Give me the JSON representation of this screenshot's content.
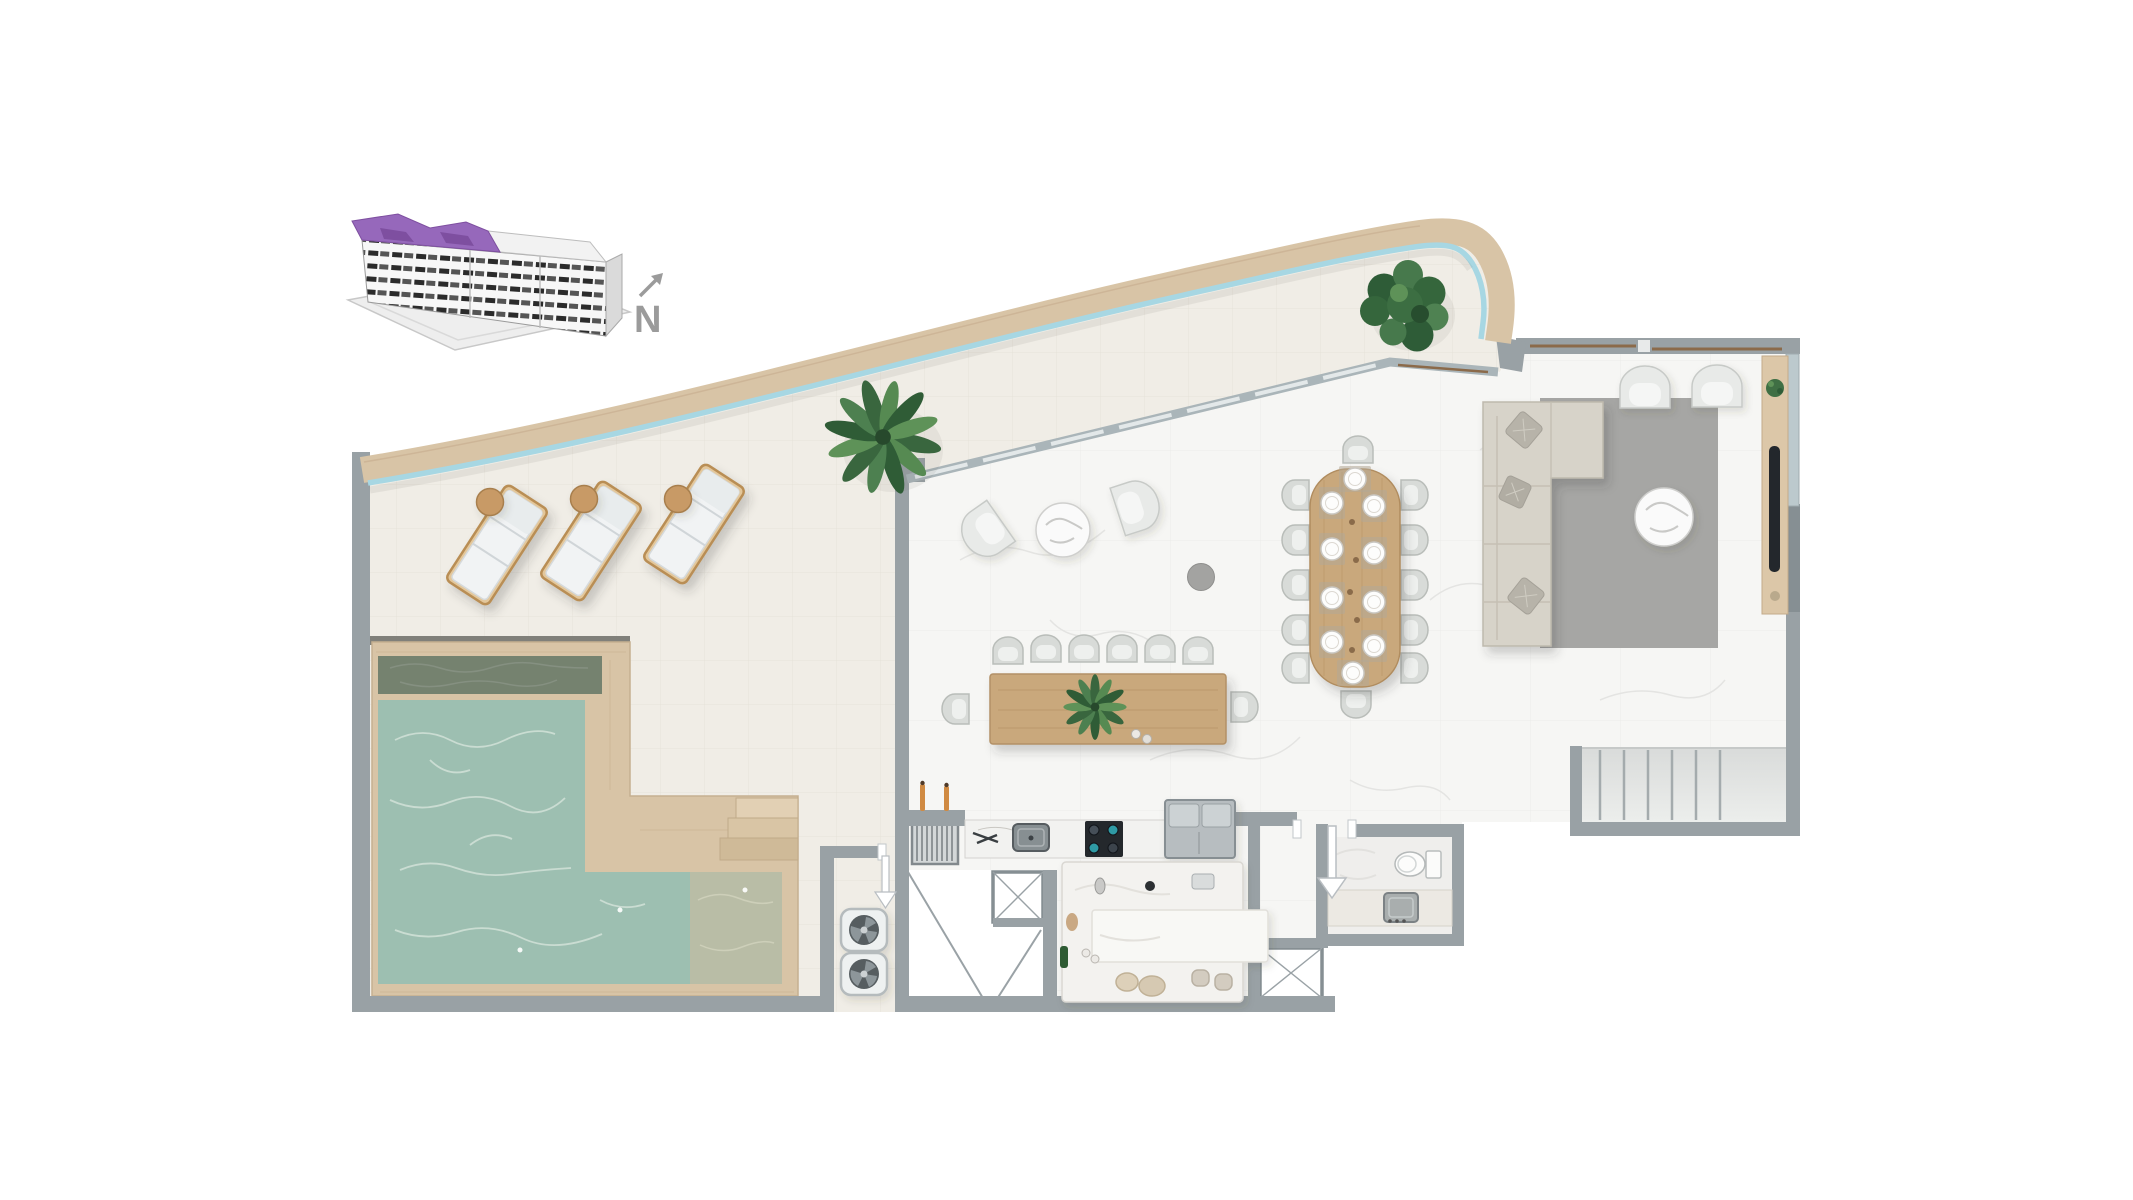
{
  "compass": {
    "label": "N"
  },
  "palette": {
    "highlight_purple": "#9668bb",
    "highlight_purple_dark": "#7e4fa0",
    "deck_tan": "#d8c4a6",
    "glass_blue": "#a7d7e3",
    "wall_gray": "#99a1a5",
    "pool_water": "#9dbfb1",
    "pool_water_dark": "#75826f",
    "pool_shelf": "#b9bda6",
    "wood": "#c9a87c",
    "rug_gray": "#a6a6a4",
    "plant_green": "#4a7c4f",
    "arrow_gray": "#9b9b9b"
  },
  "icons": [
    "building-locator-icon",
    "north-arrow-icon",
    "fan-icon",
    "elevator-icon",
    "stairs-icon",
    "entry-arrow-icon",
    "palm-plant-icon",
    "toilet-icon"
  ]
}
